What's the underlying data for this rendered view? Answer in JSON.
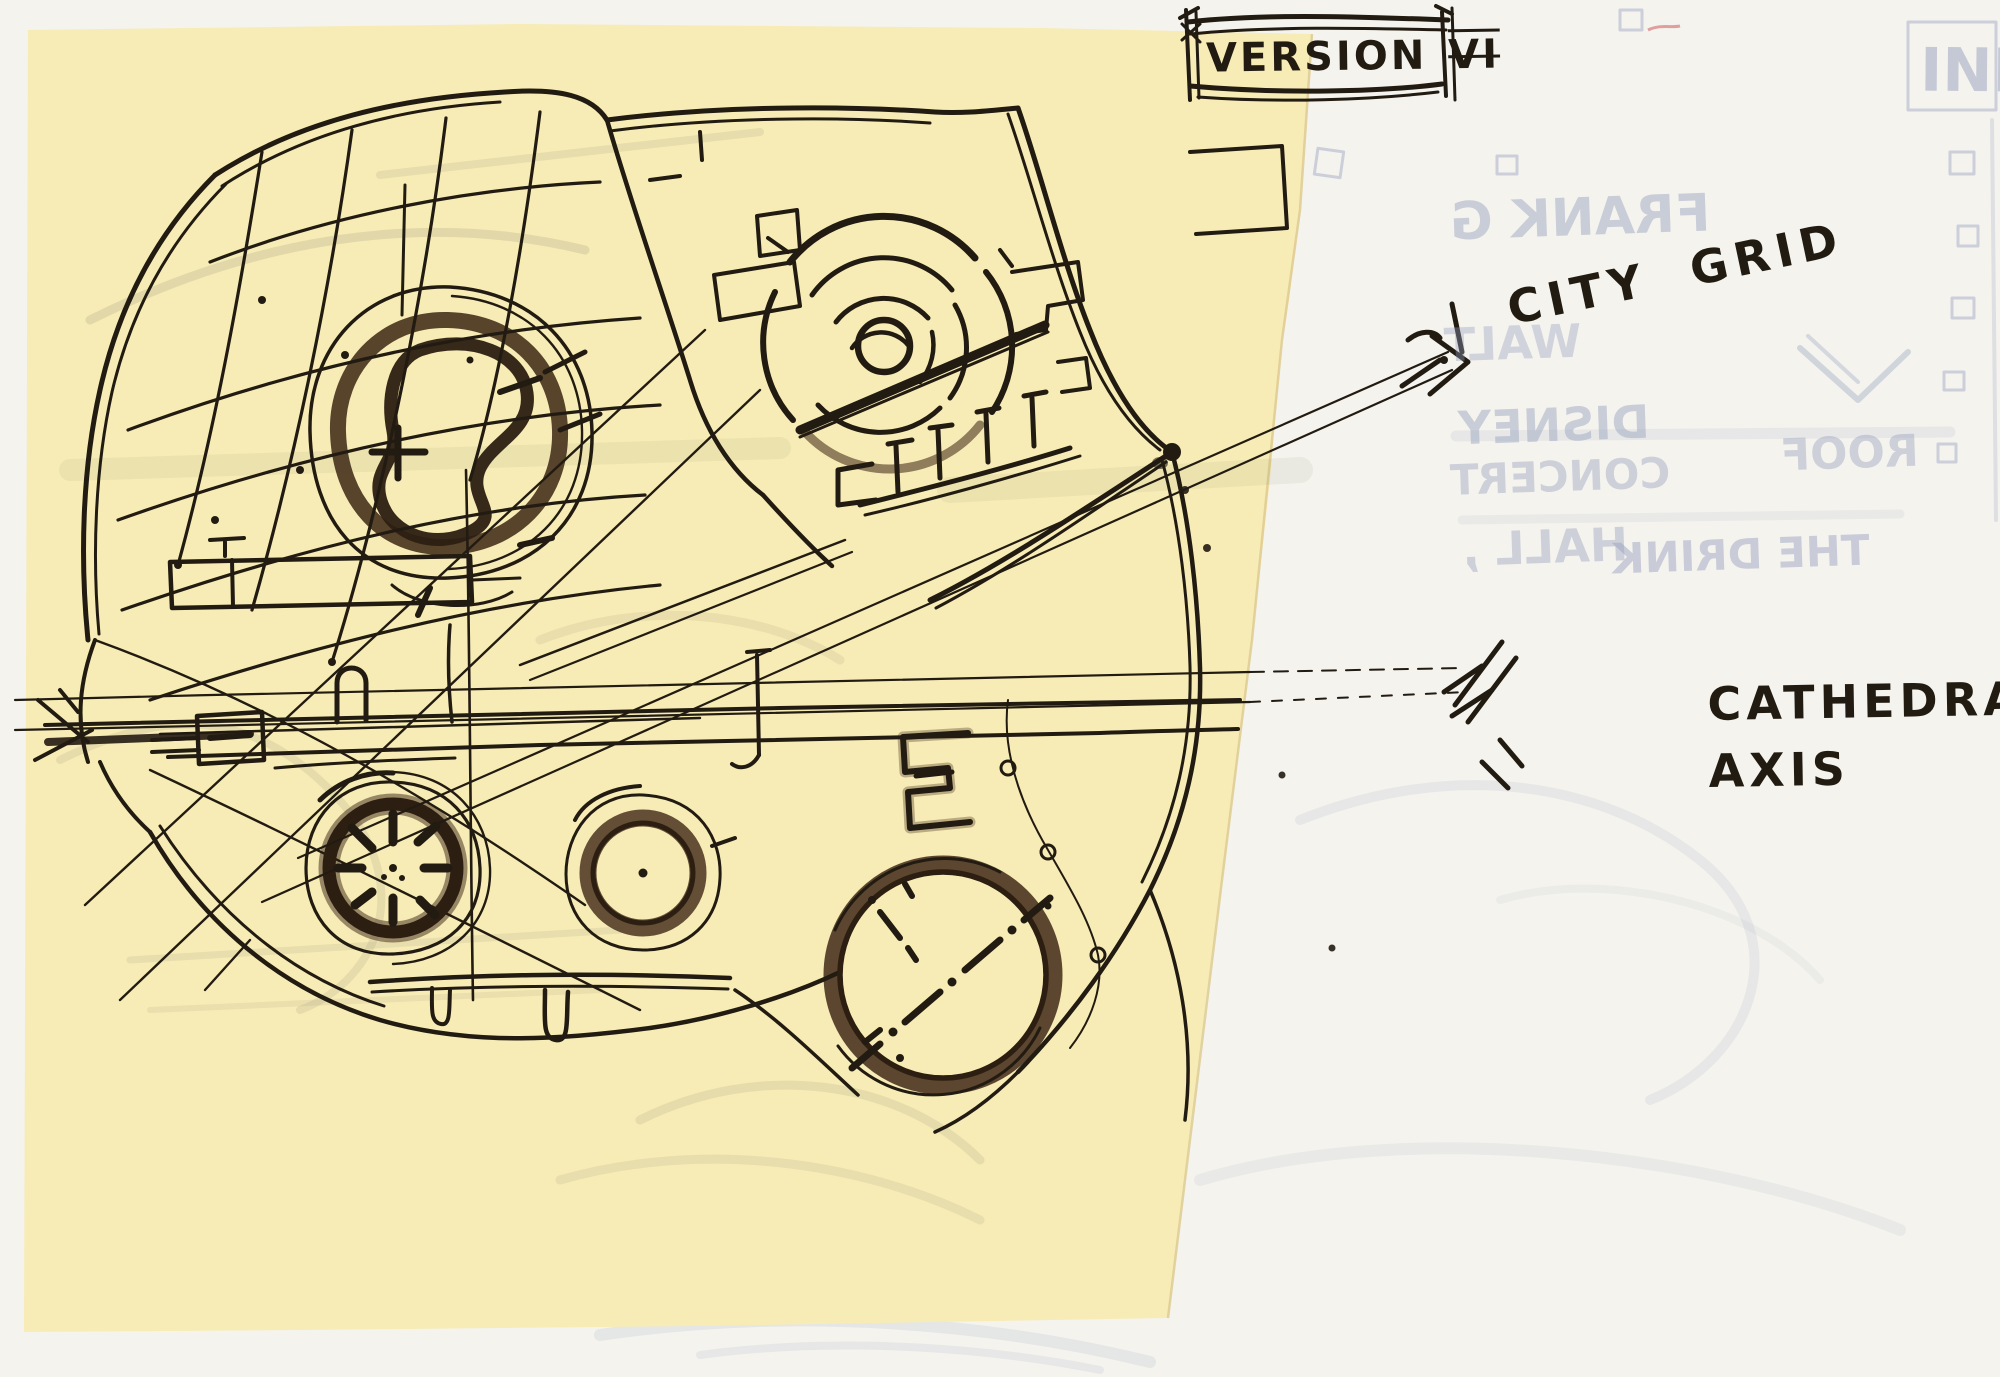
{
  "labels": {
    "version_box": {
      "word": "VERSION",
      "numeral": "VI"
    },
    "city_grid": "CITY GRID",
    "cathedral_axis": {
      "line1": "CATHEDRAL",
      "line2": "AXIS"
    }
  },
  "ghost_text": {
    "items": [
      "FRANK G",
      "WALT",
      "DISNEY",
      "CONCERT",
      "ROOF",
      "HALL ,",
      "THE DRINK",
      "INI"
    ]
  },
  "colors": {
    "backing_paper": "#f4f3ee",
    "trace_paper": "#f7ecb5",
    "trace_paper_edge": "#dcc98e",
    "ink": "#221b12",
    "ink_brown": "#2c1f12",
    "marker_brown": "#4a3420",
    "pencil_ghost": "#9aa4bf",
    "pencil_gray": "#8d8776",
    "red_fleck": "#d4666a"
  },
  "sketch": {
    "features": [
      "site-boundary-blob",
      "city-grid-mesh",
      "garden-spiral-tree",
      "tilted-concert-block",
      "amphitheater-concentric-rings",
      "cathedral-axis-corridor",
      "spoked-rotunda",
      "small-rotunda",
      "large-dashed-rotunda",
      "stepped-notch",
      "city-grid-leader-lines",
      "cathedral-axis-leader-lines",
      "city-grid-arrowhead",
      "cathedral-axis-arrowhead",
      "version-title-box"
    ]
  }
}
